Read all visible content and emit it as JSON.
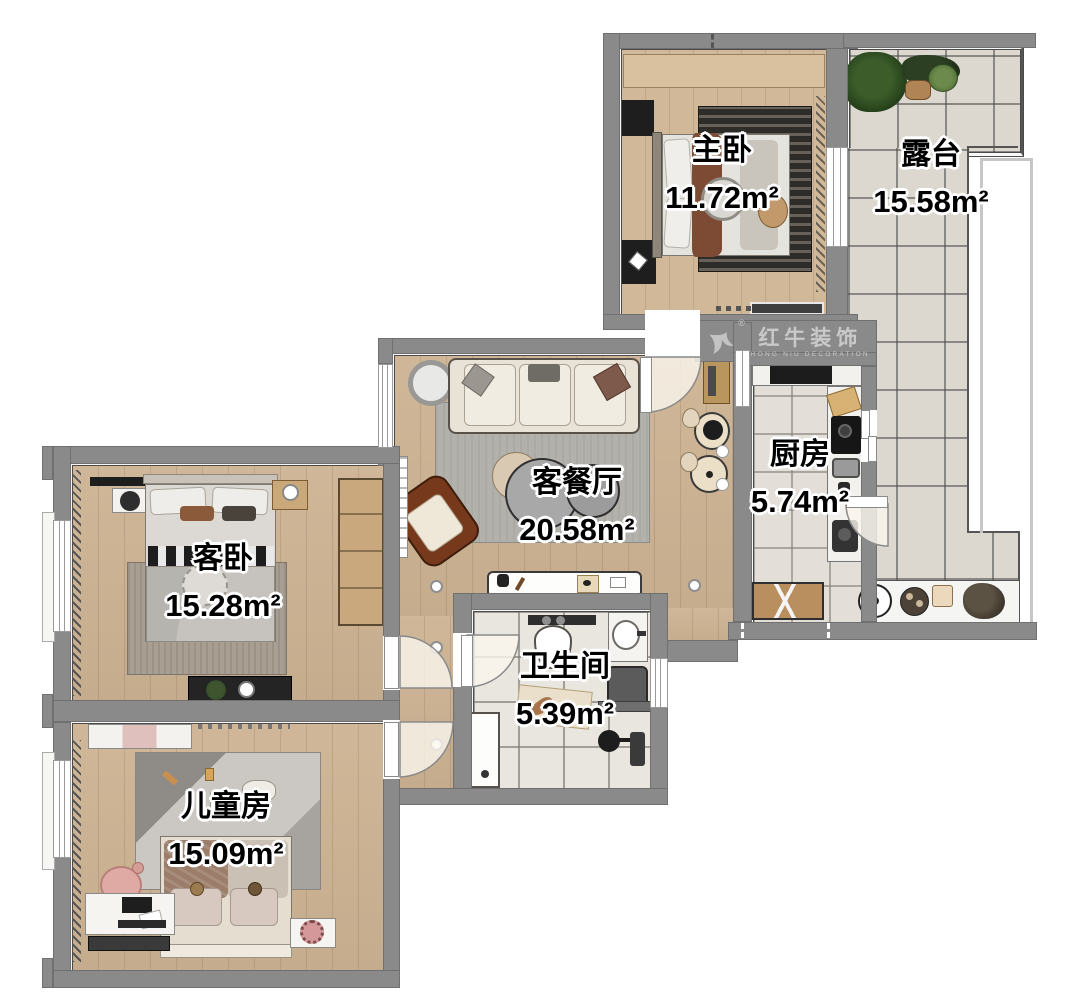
{
  "plan_title": "apartment-floor-plan",
  "logo": {
    "brand": "红牛装饰",
    "subtitle": "HONG NIU DECORATION",
    "registered": "®"
  },
  "rooms": {
    "master": {
      "name": "主卧",
      "area": "11.72m²"
    },
    "terrace": {
      "name": "露台",
      "area": "15.58m²"
    },
    "kitchen": {
      "name": "厨房",
      "area": "5.74m²"
    },
    "living": {
      "name": "客餐厅",
      "area": "20.58m²"
    },
    "guest": {
      "name": "客卧",
      "area": "15.28m²"
    },
    "bathroom": {
      "name": "卫生间",
      "area": "5.39m²"
    },
    "kids": {
      "name": "儿童房",
      "area": "15.09m²"
    }
  },
  "colors": {
    "wall": "#8a8a8a",
    "wood_floor": "#cdb393",
    "tile_floor": "#dcd8cf",
    "armchair_brown": "#76391c",
    "label_text": "#000000",
    "label_outline": "#ffffff"
  }
}
